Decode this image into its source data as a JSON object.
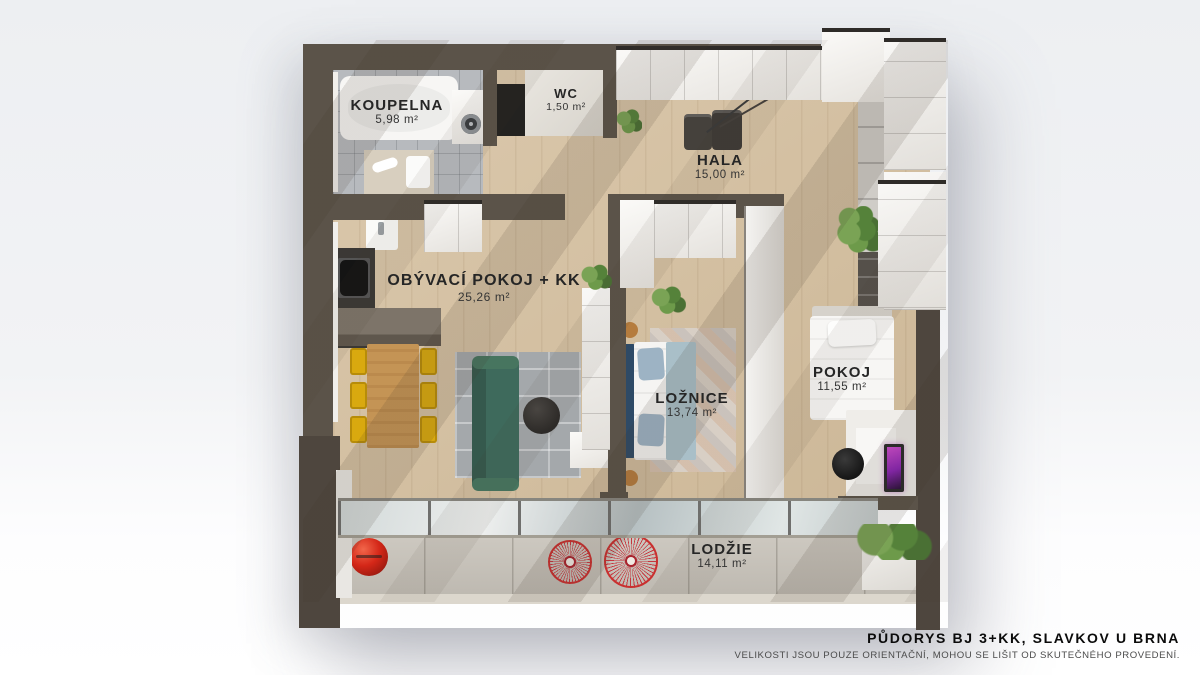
{
  "rooms": [
    {
      "id": "koupelna",
      "name": "KOUPELNA",
      "area": "5,98 m²"
    },
    {
      "id": "wc",
      "name": "WC",
      "area": "1,50 m²"
    },
    {
      "id": "hala",
      "name": "HALA",
      "area": "15,00 m²"
    },
    {
      "id": "obyvaci-pokoj",
      "name": "OBÝVACÍ POKOJ + KK",
      "area": "25,26 m²"
    },
    {
      "id": "loznice",
      "name": "LOŽNICE",
      "area": "13,74 m²"
    },
    {
      "id": "pokoj",
      "name": "POKOJ",
      "area": "11,55 m²"
    },
    {
      "id": "lodzie",
      "name": "LODŽIE",
      "area": "14,11 m²"
    }
  ],
  "footer": {
    "title": "PŮDORYS BJ 3+KK, SLAVKOV U BRNA",
    "disclaimer": "VELIKOSTI JSOU POUZE ORIENTAČNÍ, MOHOU SE LIŠIT OD SKUTEČNÉHO PROVEDENÍ."
  },
  "colors": {
    "bg-top": "#edeff2",
    "bg-bottom": "#ffffff",
    "wall": "#5b5349",
    "wall-dark": "#4e463e",
    "wood": "#d6c1a1",
    "tile": "#b7babe",
    "concrete": "#c9c4bb",
    "counter-dark": "#3b3835",
    "counter-gray": "#7d7469",
    "table-wood": "#c49455",
    "chair-yellow": "#d9a90f",
    "sofa-green": "#3e6a5c",
    "rug-gray": "#a4a8ab",
    "bed-blue": "#a9bfc8",
    "headboard-navy": "#2e4a66",
    "accent-red": "#c9302f",
    "glass": "#cdd6d7",
    "text": "#262626",
    "text-muted": "#4b4b4b"
  }
}
